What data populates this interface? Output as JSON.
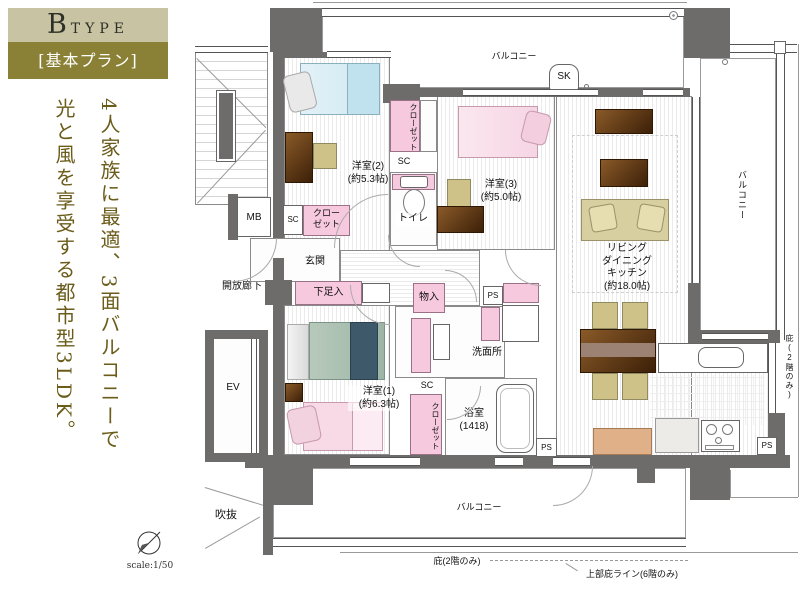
{
  "header": {
    "type_main": "B",
    "type_sub": "TYPE",
    "plan_label": "[基本プラン]"
  },
  "tagline": {
    "line1": "4人家族に最適、3面バルコニーで",
    "line2": "光と風を享受する都市型3LDK。"
  },
  "footer": {
    "scale_label": "scale:1/50"
  },
  "rooms": {
    "west2": {
      "name": "洋室(2)",
      "size": "(約5.3帖)"
    },
    "west3": {
      "name": "洋室(3)",
      "size": "(約5.0帖)"
    },
    "west1": {
      "name": "洋室(1)",
      "size": "(約6.3帖)"
    },
    "ldk": {
      "line1": "リビング",
      "line2": "ダイニング",
      "line3": "キッチン",
      "size": "(約18.0帖)"
    },
    "bath": {
      "name": "浴室",
      "size": "(1418)"
    },
    "washroom": "洗面所",
    "toilet": "トイレ",
    "entrance": "玄関"
  },
  "labels": {
    "balcony": "バルコニー",
    "sk": "SK",
    "mb": "MB",
    "ev": "EV",
    "sc": "SC",
    "ps": "PS",
    "closet_line1": "クロー",
    "closet_line2": "ゼット",
    "shoe_box": "下足入",
    "storage": "物入",
    "open_corridor": "開放廊下",
    "void_space": "吹抜",
    "eave_2f": "庇(2階のみ)",
    "upper_eave_6f": "上部庇ライン(6階のみ)"
  },
  "colors": {
    "accent_light": "#c7c3a3",
    "accent_dark": "#8a8136",
    "tagline_text": "#6b5c1a",
    "wall": "#6e6c6a",
    "fixture_pink": "#f7c9de"
  }
}
